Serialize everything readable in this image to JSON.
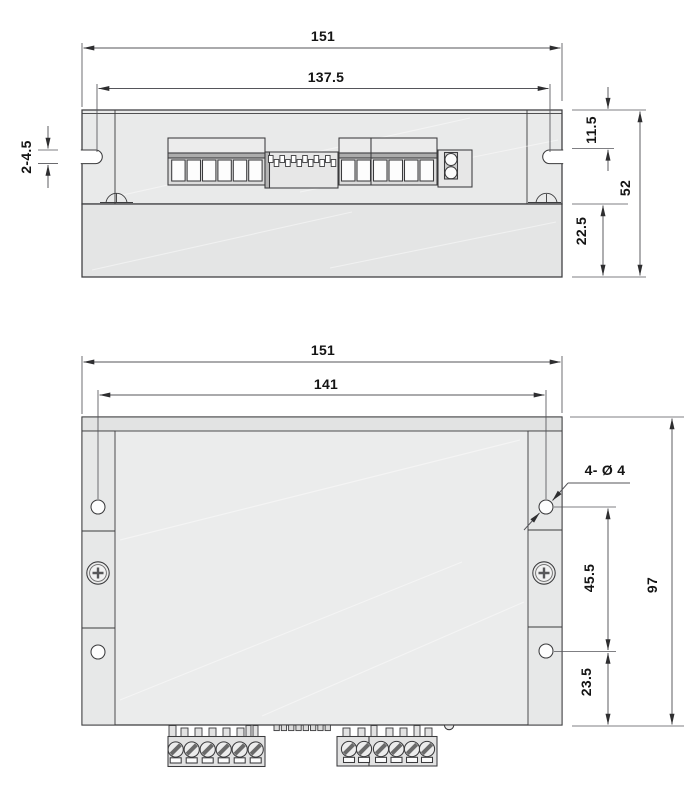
{
  "drawing_type": "mechanical-dimension-drawing",
  "colors": {
    "background": "#ffffff",
    "body_fill": "#e9eaea",
    "base_fill": "#e4e5e5",
    "panel_fill": "#ebecec",
    "outline": "#3b3b3d",
    "dimension": "#55555a",
    "text": "#141414"
  },
  "top_view": {
    "overall_width": "151",
    "slot_center_span": "137.5",
    "slot_size": "2-4.5",
    "edge_to_slot": "11.5",
    "overall_height": "52",
    "base_height": "22.5"
  },
  "front_view": {
    "overall_width": "151",
    "hole_span_width": "141",
    "hole_callout": "4- Ø 4",
    "hole_span_height": "45.5",
    "overall_height": "97",
    "hole_to_bottom": "23.5"
  }
}
